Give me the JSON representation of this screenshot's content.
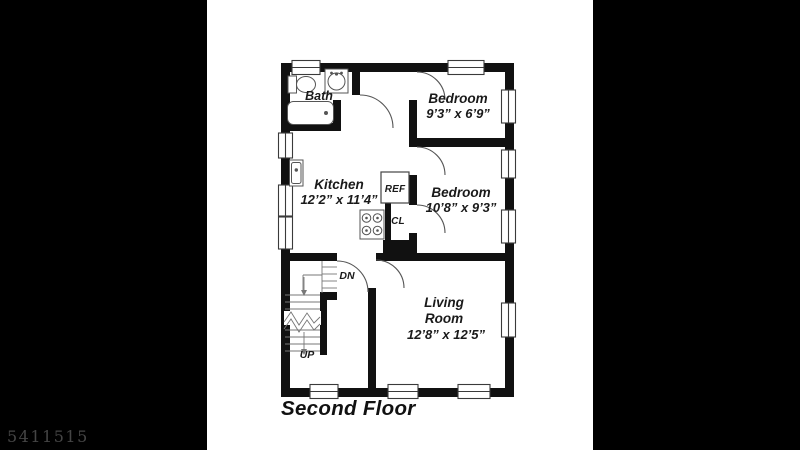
{
  "watermark": "5411515",
  "title": "Second Floor",
  "labels": {
    "bath": "Bath",
    "bedroom1_name": "Bedroom",
    "bedroom1_dims": "9’3” x 6’9”",
    "kitchen_name": "Kitchen",
    "kitchen_dims": "12’2” x 11’4”",
    "bedroom2_name": "Bedroom",
    "bedroom2_dims": "10’8” x 9’3”",
    "living_name_line1": "Living",
    "living_name_line2": "Room",
    "living_dims": "12’8” x 12’5”",
    "ref": "REF",
    "closet": "CL",
    "down": "DN",
    "up": "UP"
  },
  "colors": {
    "background": "#000000",
    "paper": "#ffffff",
    "wall": "#111111",
    "thin_line": "#666666",
    "label_text": "#1a1a1a",
    "watermark_text": "#454545"
  }
}
